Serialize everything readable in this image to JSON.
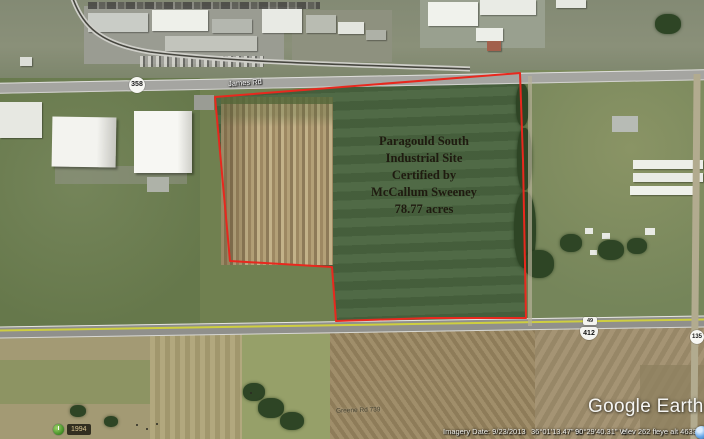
{
  "app": {
    "name": "Google Earth"
  },
  "watermark": {
    "text": "Google Earth"
  },
  "site_label": {
    "lines": [
      "Paragould South",
      "Industrial Site",
      "Certified by",
      "McCallum Sweeney",
      "78.77 acres"
    ]
  },
  "roads": {
    "route_358": "358",
    "top_road_name": "James Rd",
    "route_412": "412",
    "route_49": "49",
    "route_135": "135",
    "bottom_road_name": "Greene Rd 739"
  },
  "status_bar": {
    "history_year": "1994",
    "imagery_date": "Imagery Date: 9/23/2013",
    "latitude": "36°01'13.47\" N",
    "longitude": "90°29'40.31\" W",
    "elevation": "elev  262 ft",
    "eye_altitude": "eye alt  4633 ft"
  },
  "colors": {
    "boundary": "#e8281e"
  }
}
